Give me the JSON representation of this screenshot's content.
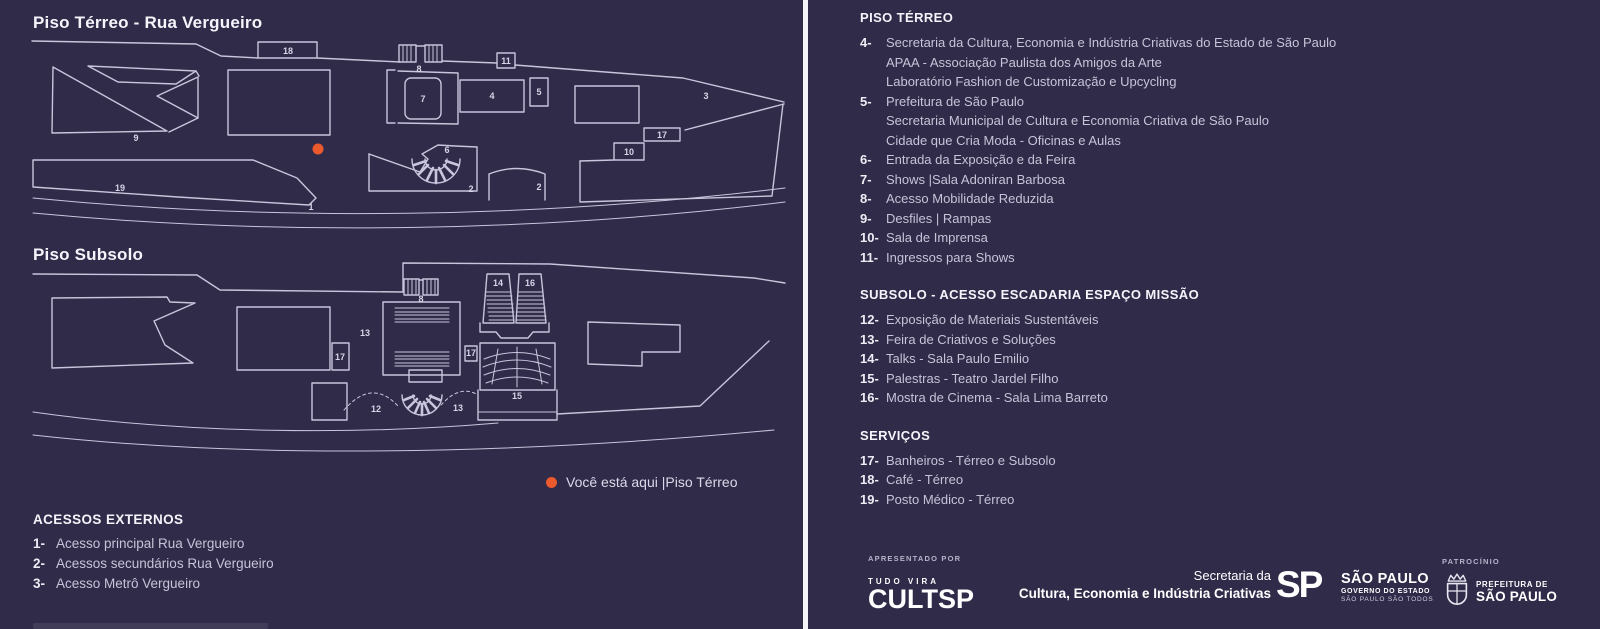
{
  "colors": {
    "background": "#2f2b49",
    "line": "#c9c5dc",
    "accent_orange": "#ea5a2d",
    "divider": "#f4f3f6",
    "text_primary": "#f2f1f7",
    "text_secondary": "#c7c3d8"
  },
  "left": {
    "terreo_title": "Piso Térreo - Rua Vergueiro",
    "subsolo_title": "Piso Subsolo",
    "you_are_here": "Você está aqui |Piso Térreo",
    "acessos": {
      "header": "ACESSOS EXTERNOS",
      "items": [
        {
          "num": "1-",
          "text": "Acesso principal Rua Vergueiro"
        },
        {
          "num": "2-",
          "text": "Acessos secundários Rua Vergueiro"
        },
        {
          "num": "3-",
          "text": "Acesso Metrô Vergueiro"
        }
      ]
    },
    "terreo_labels": [
      {
        "n": "18",
        "x": 260,
        "y": 24
      },
      {
        "n": "8",
        "x": 391,
        "y": 42
      },
      {
        "n": "11",
        "x": 478,
        "y": 34
      },
      {
        "n": "9",
        "x": 108,
        "y": 111
      },
      {
        "n": "7",
        "x": 395,
        "y": 72
      },
      {
        "n": "4",
        "x": 464,
        "y": 69
      },
      {
        "n": "5",
        "x": 511,
        "y": 65
      },
      {
        "n": "3",
        "x": 678,
        "y": 69
      },
      {
        "n": "17",
        "x": 634,
        "y": 108
      },
      {
        "n": "10",
        "x": 601,
        "y": 125
      },
      {
        "n": "6",
        "x": 419,
        "y": 123
      },
      {
        "n": "2",
        "x": 443,
        "y": 162
      },
      {
        "n": "2",
        "x": 511,
        "y": 160
      },
      {
        "n": "19",
        "x": 92,
        "y": 161
      },
      {
        "n": "1",
        "x": 283,
        "y": 180
      }
    ],
    "subsolo_labels": [
      {
        "n": "8",
        "x": 393,
        "y": 40
      },
      {
        "n": "13",
        "x": 337,
        "y": 74
      },
      {
        "n": "17",
        "x": 312,
        "y": 98
      },
      {
        "n": "14",
        "x": 470,
        "y": 24
      },
      {
        "n": "16",
        "x": 502,
        "y": 24
      },
      {
        "n": "17",
        "x": 443,
        "y": 94
      },
      {
        "n": "15",
        "x": 489,
        "y": 137
      },
      {
        "n": "12",
        "x": 348,
        "y": 150
      },
      {
        "n": "13",
        "x": 430,
        "y": 149
      }
    ]
  },
  "right": {
    "sections": [
      {
        "header": "PISO TÉRREO",
        "items": [
          {
            "num": "4-",
            "text": "Secretaria da Cultura, Economia e Indústria Criativas do Estado de São Paulo"
          },
          {
            "num": "",
            "text": "APAA - Associação Paulista dos Amigos da Arte"
          },
          {
            "num": "",
            "text": "Laboratório Fashion de Customização e Upcycling"
          },
          {
            "num": "5-",
            "text": "Prefeitura de São Paulo"
          },
          {
            "num": "",
            "text": "Secretaria Municipal de Cultura e Economia Criativa de São Paulo"
          },
          {
            "num": "",
            "text": "Cidade que Cria Moda - Oficinas e Aulas"
          },
          {
            "num": "6-",
            "text": "Entrada da Exposição e da Feira"
          },
          {
            "num": "7-",
            "text": "Shows |Sala Adoniran Barbosa"
          },
          {
            "num": "8-",
            "text": "Acesso Mobilidade Reduzida"
          },
          {
            "num": "9-",
            "text": "Desfiles | Rampas"
          },
          {
            "num": "10-",
            "text": "Sala de Imprensa"
          },
          {
            "num": "11-",
            "text": "Ingressos para Shows"
          }
        ]
      },
      {
        "header": "SUBSOLO - ACESSO ESCADARIA ESPAÇO MISSÃO",
        "items": [
          {
            "num": "12-",
            "text": "Exposição de Materiais Sustentáveis"
          },
          {
            "num": "13-",
            "text": "Feira de Criativos e Soluções"
          },
          {
            "num": "14-",
            "text": "Talks - Sala Paulo Emilio"
          },
          {
            "num": "15-",
            "text": "Palestras - Teatro Jardel Filho"
          },
          {
            "num": "16-",
            "text": "Mostra de Cinema - Sala Lima Barreto"
          }
        ]
      },
      {
        "header": "SERVIÇOS",
        "items": [
          {
            "num": "17-",
            "text": "Banheiros - Térreo e Subsolo"
          },
          {
            "num": "18-",
            "text": "Café - Térreo"
          },
          {
            "num": "19-",
            "text": "Posto Médico - Térreo"
          }
        ]
      }
    ],
    "footer": {
      "apresentado_label": "APRESENTADO POR",
      "cultsp_top": "TUDO VIRA",
      "cultsp_main": "CULTSP",
      "secretaria_line1": "Secretaria da",
      "secretaria_line2": "Cultura, Economia e Indústria Criativas",
      "sp_logo": "SP",
      "sp_name": "SÃO PAULO",
      "sp_sub1": "GOVERNO DO ESTADO",
      "sp_sub2": "SÃO PAULO SÃO TODOS",
      "patrocinio_label": "PATROCÍNIO",
      "pref_line1": "PREFEITURA DE",
      "pref_line2": "SÃO PAULO"
    }
  }
}
